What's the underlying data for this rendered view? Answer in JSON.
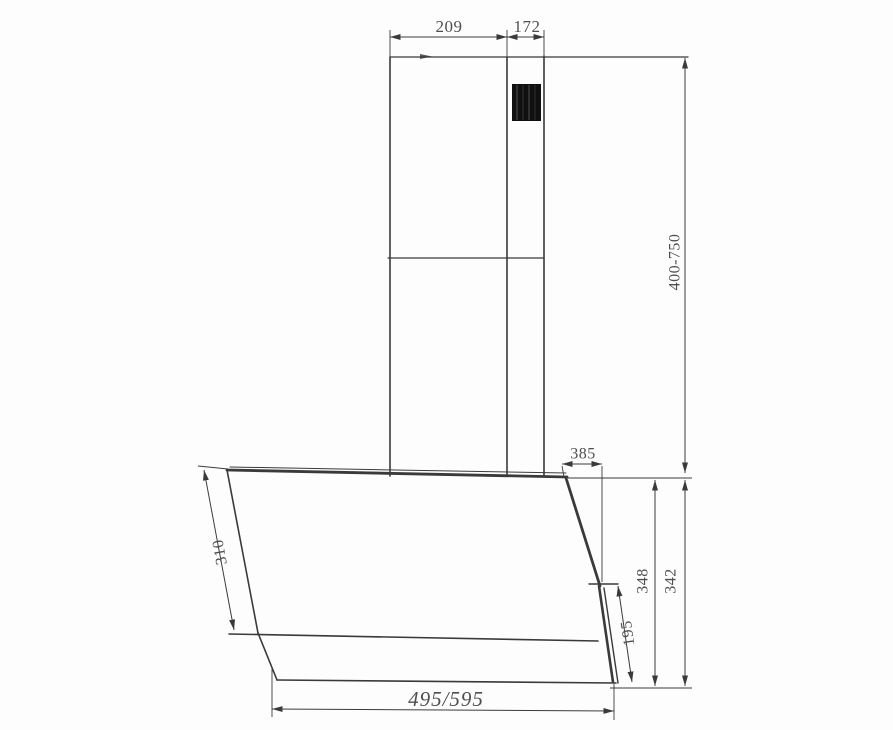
{
  "diagram": {
    "type": "technical-dimension-drawing",
    "labels": {
      "dim_209": "209",
      "dim_172": "172",
      "dim_400_750": "400-750",
      "dim_385": "385",
      "dim_310": "310",
      "dim_348": "348",
      "dim_342": "342",
      "dim_195": "195",
      "dim_495_595": "495/595"
    },
    "colors": {
      "line": "#3a3a3a",
      "text": "#4f4f4f",
      "vent": "#101010",
      "background": "#fdfdfd"
    }
  }
}
